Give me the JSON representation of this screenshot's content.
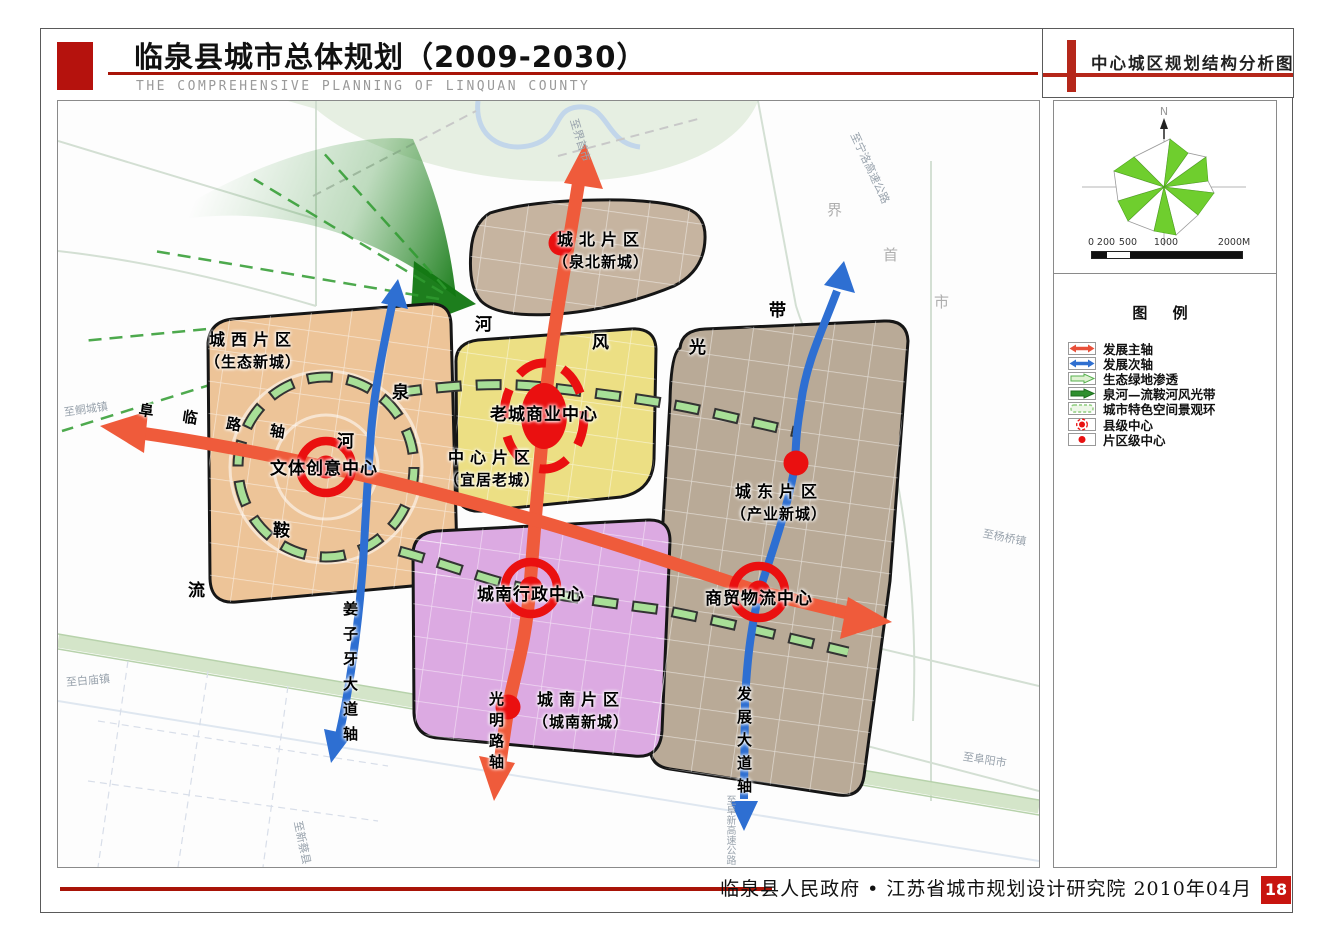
{
  "header": {
    "title": "临泉县城市总体规划（2009-2030）",
    "subtitle": "THE COMPREHENSIVE PLANNING OF LINQUAN COUNTY",
    "panel_title": "中心城区规划结构分析图"
  },
  "footer": {
    "credit": "临泉县人民政府 • 江苏省城市规划设计研究院  2010年04月",
    "page_number": "18"
  },
  "compass": {
    "north": "N",
    "scale_ticks": [
      "0",
      "200",
      "500",
      "1000",
      "2000M"
    ]
  },
  "legend": {
    "title": "图  例",
    "items": [
      {
        "label": "发展主轴",
        "symbol": "red-double-arrow"
      },
      {
        "label": "发展次轴",
        "symbol": "blue-double-arrow"
      },
      {
        "label": "生态绿地渗透",
        "symbol": "light-green-arrow"
      },
      {
        "label": "泉河—流鞍河风光带",
        "symbol": "green-arrow"
      },
      {
        "label": "城市特色空间景观环",
        "symbol": "green-dashed-ring"
      },
      {
        "label": "县级中心",
        "symbol": "red-dot-dashed-ring"
      },
      {
        "label": "片区级中心",
        "symbol": "red-dot"
      }
    ]
  },
  "map": {
    "districts": [
      {
        "name": "城北片区",
        "alias": "（泉北新城）"
      },
      {
        "name": "城西片区",
        "alias": "（生态新城）"
      },
      {
        "name": "中心片区",
        "alias": "（宜居老城）"
      },
      {
        "name": "城东片区",
        "alias": "（产业新城）"
      },
      {
        "name": "城南片区",
        "alias": "（城南新城）"
      }
    ],
    "centers": [
      {
        "name": "老城商业中心"
      },
      {
        "name": "文体创意中心"
      },
      {
        "name": "城南行政中心"
      },
      {
        "name": "商贸物流中心"
      }
    ],
    "axes": [
      {
        "name": "阜 临 路 轴"
      },
      {
        "name": "姜子牙大道轴"
      },
      {
        "name": "光明路轴"
      },
      {
        "name": "发展大道轴"
      }
    ],
    "corridor_chars": [
      "泉",
      "河",
      "风",
      "光",
      "带"
    ],
    "river_chars": [
      "流",
      "鞍",
      "河"
    ],
    "boundary_chars": [
      "界",
      "首",
      "市"
    ],
    "road_labels": [
      "至鲖城镇",
      "至白庙镇",
      "至界首市",
      "至宁洛高速公路",
      "至杨桥镇",
      "至阜阳市",
      "至新蔡县",
      "至阜新高速公路"
    ]
  },
  "colors": {
    "accent_red": "#a81408",
    "logo_red": "#b5120d",
    "axis_primary": "#ef5b3b",
    "axis_secondary": "#2e6fd2",
    "center_red": "#ea1010",
    "eco_green": "#2f8f2f",
    "ring_green": "#a8df97",
    "district_north": "#c6b4a0",
    "district_west": "#edc498",
    "district_center": "#ecdf84",
    "district_east": "#b9aa97",
    "district_south": "#dcaae2"
  }
}
